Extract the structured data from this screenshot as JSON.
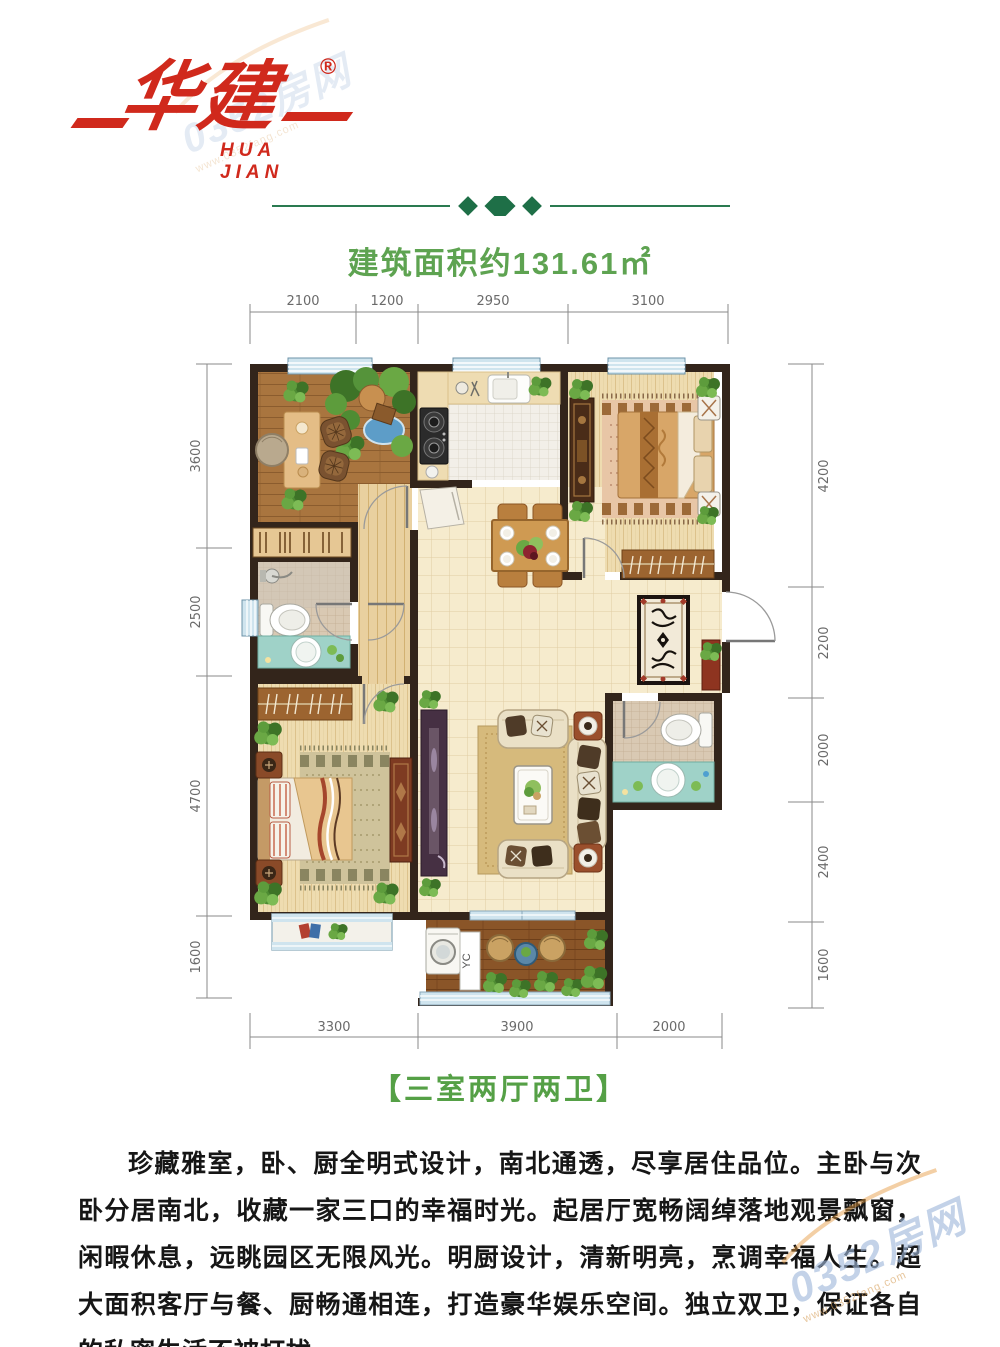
{
  "brand": {
    "logo_cn": "华建",
    "logo_en": "HUA JIAN",
    "registered": "®"
  },
  "header": {
    "area_title": "建筑面积约131.61㎡"
  },
  "plan": {
    "dims": {
      "top": [
        "2100",
        "1200",
        "2950",
        "3100"
      ],
      "left": [
        "3600",
        "2500",
        "4700",
        "1600"
      ],
      "right": [
        "4200",
        "2200",
        "2000",
        "2400",
        "1600"
      ],
      "bottom": [
        "3300",
        "3900",
        "2000"
      ]
    },
    "laundry_label": "YC"
  },
  "tagline": "【三室两厅两卫】",
  "description": "珍藏雅室，卧、厨全明式设计，南北通透，尽享居住品位。主卧与次卧分居南北，收藏一家三口的幸福时光。起居厅宽畅阔绰落地观景飘窗，闲暇休息，远眺园区无限风光。明厨设计，清新明亮，烹调幸福人生。超大面积客厅与餐、厨畅通相连，打造豪华娱乐空间。独立双卫，保证各自的私密生活不被打扰。",
  "watermark": {
    "name": "0352房网",
    "site": "www.0352fang.com"
  },
  "colors": {
    "brand_red": "#d0291c",
    "title_green": "#5ea351",
    "divider_green": "#1e6f47",
    "wall": "#33251b"
  }
}
